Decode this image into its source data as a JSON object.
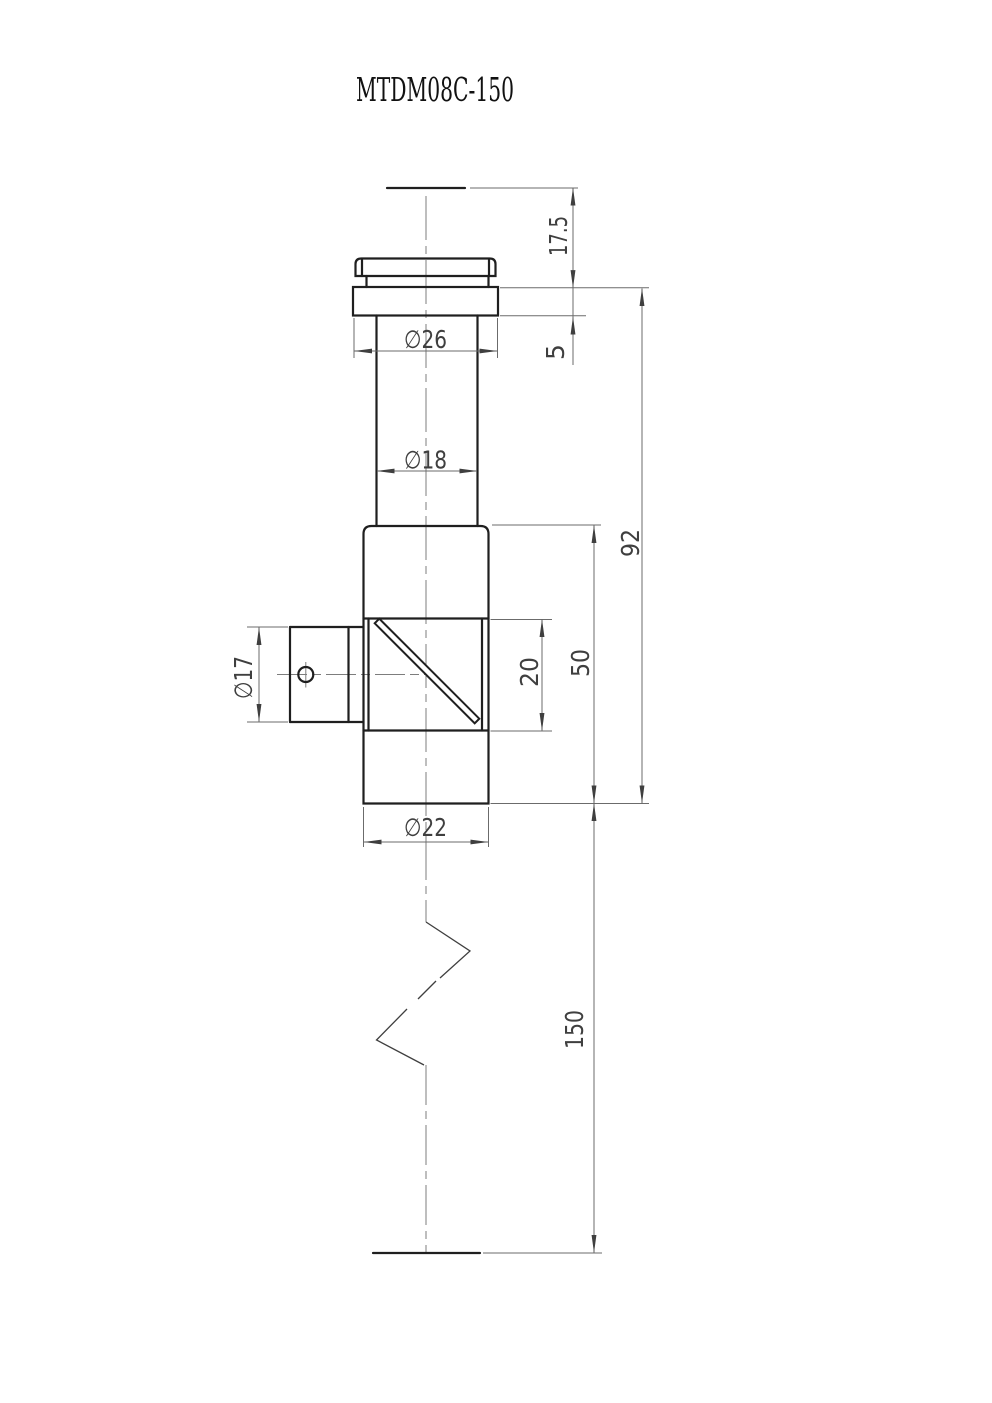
{
  "title": "MTDM08C-150",
  "dimensions": {
    "eyepiece_height": "17.5",
    "flange_thickness": "5",
    "flange_dia": "∅26",
    "eyepiece_tube_dia": "∅18",
    "upper_assembly_length": "92",
    "head_length": "50",
    "prism_window_length": "20",
    "side_port_dia": "∅17",
    "body_dia": "∅22",
    "overall_tube_length": "150"
  }
}
